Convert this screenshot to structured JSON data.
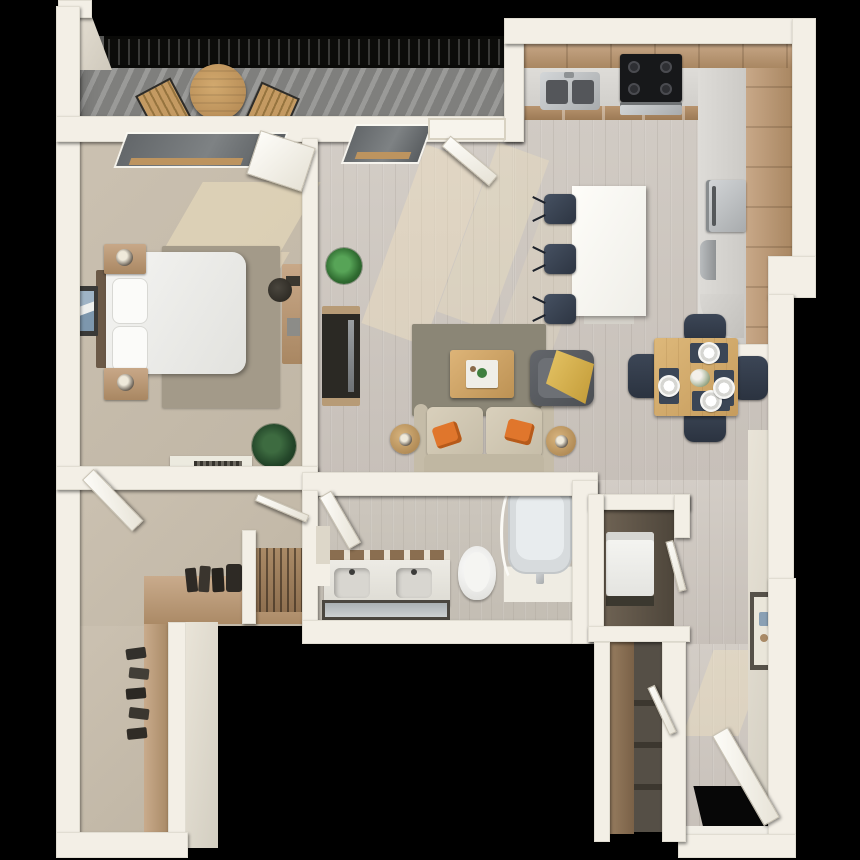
{
  "title": "3D top-down floor plan of a one-bedroom, one-bath apartment with balcony",
  "scene": {
    "background": "#000000",
    "style": "3d-dollhouse-floorplan",
    "text_visible": false
  },
  "palette": {
    "wall": "#f3efe6",
    "wallShade": "#d7d2c5",
    "carpet": "#c6bcab",
    "wood": "#cfc9c2",
    "deck": "#8b8b89",
    "railing": "#141412",
    "cabinet": "#bb9a78",
    "counter": "#d7d5d1",
    "island": "#fbfaf6",
    "navy": "#38424f",
    "oak": "#d8b171",
    "beige": "#cdc4b0",
    "orange": "#e0762c",
    "gold": "#d8b251",
    "rug": "#8b8676",
    "rugBed": "#a39a89",
    "sun": "#f2e3c0",
    "tub": "#e8ecee",
    "steel": "#c2c5c7",
    "darkWood": "#2c2a25"
  },
  "rooms": {
    "balcony": {
      "label": "balcony",
      "items": [
        "metal-railing",
        "plank-decking",
        "round-bistro-table",
        "bistro-chair-left",
        "bistro-chair-right"
      ]
    },
    "bedroom": {
      "label": "bedroom",
      "items": [
        "double-bed-white-duvet",
        "pillow-top",
        "pillow-bottom",
        "dark-headboard",
        "nightstand-lamp-top",
        "nightstand-lamp-bottom",
        "area-rug",
        "framed-wall-art",
        "desk",
        "desk-chair",
        "potted-plant",
        "low-dresser",
        "window",
        "door"
      ]
    },
    "living_room": {
      "label": "living-room",
      "items": [
        "tv-console-with-tv",
        "potted-plant",
        "area-rug",
        "coffee-table-with-tray",
        "loveseat-sofa",
        "orange-pillow-left",
        "orange-pillow-right",
        "side-table-lamp-left",
        "side-table-lamp-right",
        "accent-chair-gold-throw",
        "window",
        "balcony-sliding-door"
      ]
    },
    "kitchen": {
      "label": "kitchen",
      "items": [
        "l-shaped-wood-cabinets",
        "stainless-sink",
        "black-cooktop-oven",
        "stainless-refrigerator",
        "white-island",
        "bar-stool-1",
        "bar-stool-2",
        "bar-stool-3"
      ]
    },
    "dining_area": {
      "label": "dining-area",
      "items": [
        "square-wood-table",
        "dining-chair-top",
        "dining-chair-bottom",
        "dining-chair-left",
        "dining-chair-right",
        "place-setting-x4",
        "centerpiece-flowers"
      ]
    },
    "bathroom": {
      "label": "bathroom",
      "items": [
        "double-sink-vanity",
        "vanity-shelf-decor",
        "vanity-mirror",
        "toilet",
        "bathtub",
        "curtain-rod",
        "tub-deck-faucet",
        "linen-niche",
        "door"
      ]
    },
    "walk_in_closet": {
      "label": "walk-in-closet",
      "items": [
        "l-shaped-shelf",
        "hanging-clothes-rod",
        "handbags",
        "shoe-row",
        "door",
        "partition-wall"
      ]
    },
    "laundry_closet": {
      "label": "laundry-closet",
      "items": [
        "washer-dryer",
        "closet-door"
      ]
    },
    "utility_closet": {
      "label": "utility-closet",
      "items": [
        "shelving",
        "tall-brown-panel",
        "closet-door"
      ]
    },
    "entry": {
      "label": "entry-hall",
      "items": [
        "open-front-door",
        "black-door-opening",
        "framed-wall-art",
        "threshold"
      ]
    }
  }
}
